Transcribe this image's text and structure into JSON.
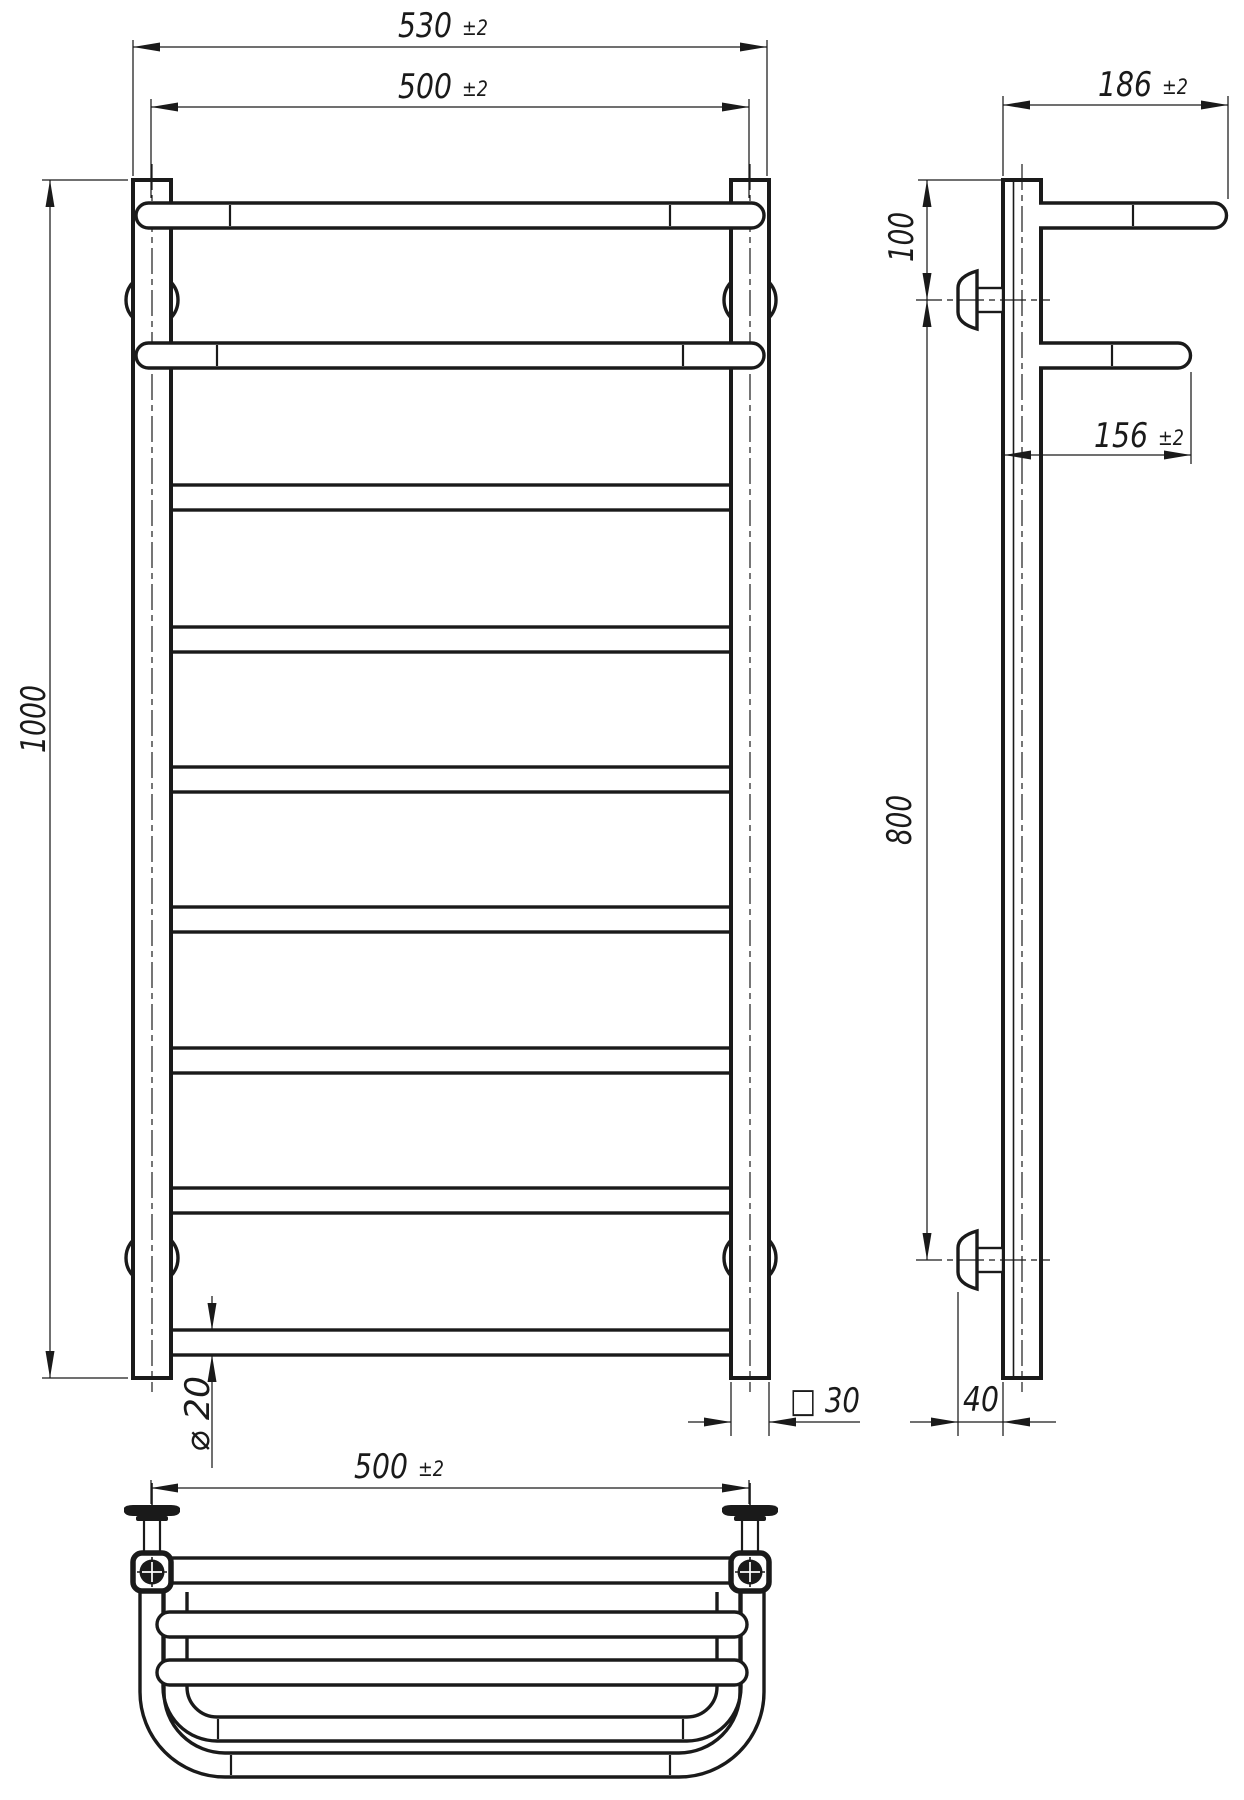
{
  "page": {
    "background": "#ffffff",
    "line_color": "#1a1a1a"
  },
  "drawing": {
    "kind": "towel-rail ladder with shelf, three-view technical drawing",
    "front_view": {
      "rung_count": 9,
      "shelf_rungs": 2,
      "posts": 2,
      "wall_brackets": 4
    },
    "dimensions": {
      "front": {
        "overall_width": {
          "value": "530",
          "tolerance": "±2"
        },
        "rail_length": {
          "value": "500",
          "tolerance": "±2"
        },
        "overall_height": {
          "value": "1000"
        },
        "tube_diameter": {
          "value": "⌀ 20"
        },
        "post_section": {
          "value": "□ 30"
        }
      },
      "side": {
        "top_shelf_depth": {
          "value": "186",
          "tolerance": "±2"
        },
        "second_shelf_depth": {
          "value": "156",
          "tolerance": "±2"
        },
        "top_bracket_offset": {
          "value": "100"
        },
        "bracket_span": {
          "value": "800"
        },
        "wall_clearance": {
          "value": "40"
        }
      },
      "bottom": {
        "rail_length": {
          "value": "500",
          "tolerance": "±2"
        }
      }
    }
  }
}
